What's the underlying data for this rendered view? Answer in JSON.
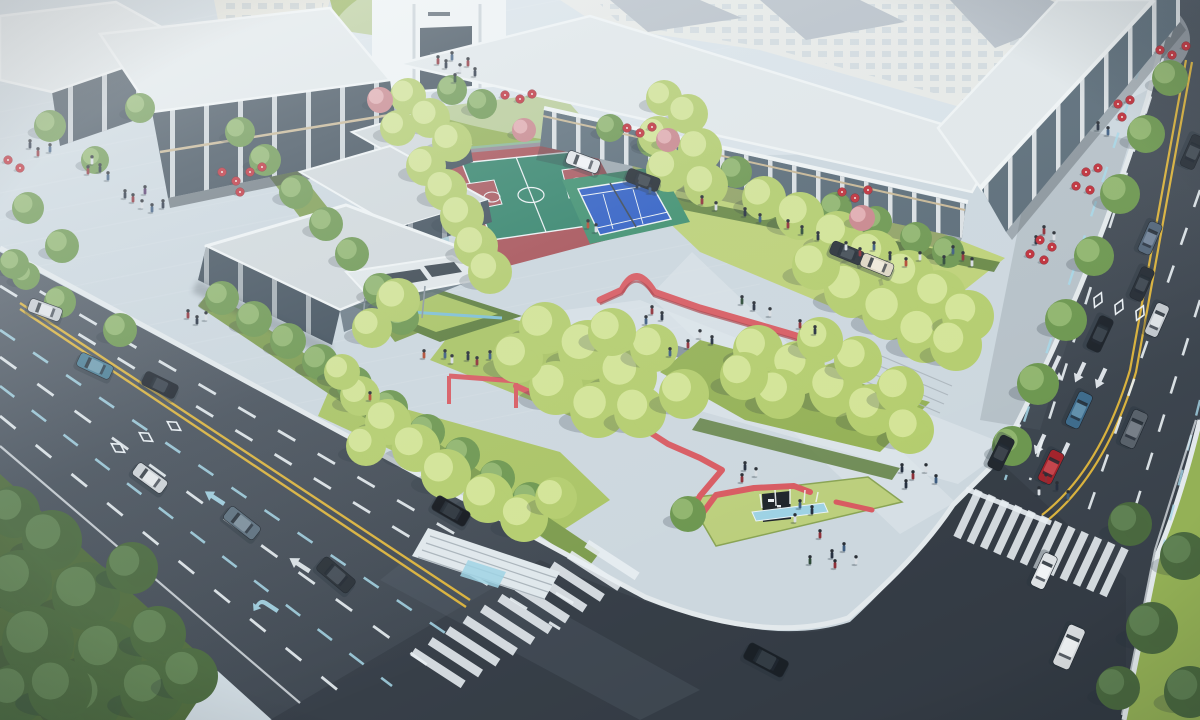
{
  "scene": {
    "description": "aerial-architectural-rendering-urban-pocket-park",
    "features": [
      "basketball-court",
      "tennis-court",
      "red-ribbon-walls",
      "park-entry-sign",
      "fountain",
      "pavilions",
      "commercial-buildings",
      "residential-blocks",
      "two-arterial-roads",
      "intersection",
      "crosswalks",
      "street-trees",
      "cafe-umbrellas",
      "pedestrians",
      "vehicles"
    ]
  },
  "palette": {
    "plaza": "#ccd7de",
    "plazaLight": "#e0e8ec",
    "path": "#d7e0e5",
    "bandLine": "#f2f6f8",
    "asphalt1": "#57616c",
    "asphalt2": "#3b434d",
    "asphaltDark": "#2f363e",
    "laneWhite": "#e9eff3",
    "laneCyan": "#a6d7e8",
    "laneYellow": "#d9b23e",
    "curb": "#e3e9ec",
    "lawn": "#aac465",
    "lawnLight": "#bdd177",
    "lawnShade": "#94b156",
    "verge": "#7d9c4e",
    "hedge": "#5f7f40",
    "hedgeLight": "#bccf7d",
    "bank": "#4f6b3d",
    "roof": "#d2d9dc",
    "roofLight": "#e2e8ea",
    "fascia": "#f0f4f5",
    "glassDark": "#414f5b",
    "glassMid": "#5a6b77",
    "colWhite": "#e9edef",
    "trim": "#c8b795",
    "resWall": "#e6e5da",
    "resWin": "#9db0bd",
    "resRoof": "#8c98a2",
    "courtRed": "#a85157",
    "courtGreen": "#33836a",
    "courtKey": "#a8565c",
    "tennisBlue": "#2f5ec4",
    "tennisGreen": "#3e8f6e",
    "lineWhite": "#eef3f5",
    "fence": "#7fb9c8",
    "ribbon": "#d85b62",
    "ribbonDark": "#aa4049",
    "water": "#9ed2e4",
    "waterDeep": "#7fc0d6",
    "umbrella": "#bf2f3a",
    "umbrellaDot": "#f0e8e2",
    "shadow": "#26323c",
    "carWindow": "#222a33",
    "signPanel": "#20262c",
    "signGlyph": "#e8ecef",
    "netDark": "#3a4754",
    "stepLine": "#aab4bb",
    "poleGray": "#8b97a0"
  },
  "tree_colors": {
    "p": {
      "b": "#b4cd6e",
      "h": "#d6e79a"
    },
    "s": {
      "b": "#6d9750",
      "h": "#93b871"
    },
    "d": {
      "b": "#4a693f",
      "h": "#628455"
    },
    "k": {
      "b": "#c9868c",
      "h": "#e4b0b4"
    }
  },
  "trees": [
    [
      14,
      512,
      26,
      "d"
    ],
    [
      52,
      540,
      30,
      "d"
    ],
    [
      20,
      582,
      32,
      "d"
    ],
    [
      86,
      596,
      34,
      "d"
    ],
    [
      38,
      642,
      36,
      "d"
    ],
    [
      108,
      655,
      34,
      "d"
    ],
    [
      16,
      694,
      30,
      "d"
    ],
    [
      88,
      700,
      34,
      "d"
    ],
    [
      152,
      692,
      32,
      "d"
    ],
    [
      158,
      634,
      28,
      "d"
    ],
    [
      132,
      568,
      26,
      "d"
    ],
    [
      190,
      676,
      28,
      "d"
    ],
    [
      60,
      690,
      32,
      "d"
    ],
    [
      222,
      298,
      17,
      "s"
    ],
    [
      254,
      319,
      18,
      "s"
    ],
    [
      288,
      341,
      18,
      "s"
    ],
    [
      320,
      362,
      18,
      "s"
    ],
    [
      354,
      384,
      18,
      "s"
    ],
    [
      390,
      408,
      18,
      "s"
    ],
    [
      427,
      432,
      18,
      "s"
    ],
    [
      462,
      455,
      18,
      "s"
    ],
    [
      497,
      478,
      18,
      "s"
    ],
    [
      530,
      500,
      18,
      "s"
    ],
    [
      60,
      302,
      16,
      "s"
    ],
    [
      120,
      330,
      17,
      "s"
    ],
    [
      26,
      276,
      14,
      "s"
    ],
    [
      140,
      108,
      15,
      "s"
    ],
    [
      240,
      132,
      15,
      "s"
    ],
    [
      265,
      160,
      16,
      "s"
    ],
    [
      296,
      192,
      17,
      "s"
    ],
    [
      326,
      224,
      17,
      "s"
    ],
    [
      352,
      254,
      17,
      "s"
    ],
    [
      380,
      290,
      17,
      "s"
    ],
    [
      402,
      318,
      17,
      "s"
    ],
    [
      50,
      126,
      16,
      "s"
    ],
    [
      28,
      208,
      16,
      "s"
    ],
    [
      62,
      246,
      17,
      "s"
    ],
    [
      14,
      264,
      15,
      "s"
    ],
    [
      95,
      160,
      14,
      "s"
    ],
    [
      452,
      90,
      15,
      "s"
    ],
    [
      482,
      104,
      15,
      "s"
    ],
    [
      610,
      128,
      14,
      "s"
    ],
    [
      652,
      142,
      15,
      "s"
    ],
    [
      694,
      158,
      16,
      "s"
    ],
    [
      736,
      172,
      16,
      "s"
    ],
    [
      836,
      208,
      16,
      "s"
    ],
    [
      876,
      222,
      16,
      "s"
    ],
    [
      916,
      238,
      16,
      "s"
    ],
    [
      948,
      252,
      16,
      "s"
    ],
    [
      408,
      96,
      18,
      "p"
    ],
    [
      430,
      118,
      20,
      "p"
    ],
    [
      452,
      142,
      20,
      "p"
    ],
    [
      426,
      166,
      20,
      "p"
    ],
    [
      398,
      128,
      18,
      "p"
    ],
    [
      446,
      190,
      21,
      "p"
    ],
    [
      462,
      216,
      22,
      "p"
    ],
    [
      476,
      246,
      22,
      "p"
    ],
    [
      490,
      272,
      22,
      "p"
    ],
    [
      664,
      98,
      18,
      "p"
    ],
    [
      688,
      114,
      20,
      "p"
    ],
    [
      658,
      136,
      20,
      "p"
    ],
    [
      700,
      150,
      22,
      "p"
    ],
    [
      668,
      170,
      22,
      "p"
    ],
    [
      706,
      185,
      22,
      "p"
    ],
    [
      764,
      198,
      22,
      "p"
    ],
    [
      800,
      216,
      24,
      "p"
    ],
    [
      838,
      236,
      25,
      "p"
    ],
    [
      874,
      256,
      26,
      "p"
    ],
    [
      908,
      276,
      26,
      "p"
    ],
    [
      940,
      296,
      26,
      "p"
    ],
    [
      852,
      290,
      28,
      "p"
    ],
    [
      890,
      312,
      28,
      "p"
    ],
    [
      925,
      335,
      28,
      "p"
    ],
    [
      816,
      266,
      24,
      "p"
    ],
    [
      968,
      316,
      26,
      "p"
    ],
    [
      956,
      345,
      26,
      "p"
    ],
    [
      545,
      328,
      26,
      "p"
    ],
    [
      588,
      350,
      30,
      "p"
    ],
    [
      628,
      376,
      29,
      "p"
    ],
    [
      556,
      388,
      27,
      "p"
    ],
    [
      598,
      410,
      28,
      "p"
    ],
    [
      518,
      358,
      25,
      "p"
    ],
    [
      654,
      348,
      24,
      "p"
    ],
    [
      640,
      412,
      26,
      "p"
    ],
    [
      684,
      394,
      25,
      "p"
    ],
    [
      612,
      332,
      24,
      "p"
    ],
    [
      758,
      350,
      25,
      "p"
    ],
    [
      798,
      368,
      27,
      "p"
    ],
    [
      836,
      390,
      27,
      "p"
    ],
    [
      872,
      410,
      26,
      "p"
    ],
    [
      900,
      390,
      24,
      "p"
    ],
    [
      858,
      360,
      24,
      "p"
    ],
    [
      820,
      340,
      23,
      "p"
    ],
    [
      780,
      394,
      25,
      "p"
    ],
    [
      744,
      376,
      24,
      "p"
    ],
    [
      910,
      430,
      24,
      "p"
    ],
    [
      360,
      396,
      20,
      "p"
    ],
    [
      388,
      422,
      23,
      "p"
    ],
    [
      416,
      448,
      24,
      "p"
    ],
    [
      366,
      446,
      20,
      "p"
    ],
    [
      446,
      474,
      25,
      "p"
    ],
    [
      488,
      498,
      25,
      "p"
    ],
    [
      342,
      372,
      18,
      "p"
    ],
    [
      524,
      518,
      24,
      "p"
    ],
    [
      556,
      498,
      21,
      "p"
    ],
    [
      688,
      514,
      18,
      "s"
    ],
    [
      398,
      300,
      22,
      "p"
    ],
    [
      372,
      328,
      20,
      "p"
    ],
    [
      1170,
      78,
      18,
      "s"
    ],
    [
      1146,
      134,
      19,
      "s"
    ],
    [
      1120,
      194,
      20,
      "s"
    ],
    [
      1094,
      256,
      20,
      "s"
    ],
    [
      1066,
      320,
      21,
      "s"
    ],
    [
      1038,
      384,
      21,
      "s"
    ],
    [
      1012,
      446,
      20,
      "s"
    ],
    [
      1130,
      524,
      22,
      "d"
    ],
    [
      1184,
      556,
      24,
      "d"
    ],
    [
      1152,
      628,
      26,
      "d"
    ],
    [
      1190,
      692,
      26,
      "d"
    ],
    [
      1118,
      688,
      22,
      "d"
    ],
    [
      380,
      100,
      13,
      "k"
    ],
    [
      524,
      130,
      12,
      "k"
    ],
    [
      668,
      140,
      12,
      "k"
    ],
    [
      862,
      218,
      13,
      "k"
    ]
  ],
  "cars": [
    {
      "x": 45,
      "y": 310,
      "r": 20,
      "l": 34,
      "w": 14,
      "b": "#c7ccd1",
      "t": "#e2e6e9"
    },
    {
      "x": 95,
      "y": 366,
      "r": 25,
      "l": 36,
      "w": 15,
      "b": "#4a7d94",
      "t": "#6f9cb0"
    },
    {
      "x": 160,
      "y": 385,
      "r": 26,
      "l": 36,
      "w": 15,
      "b": "#20262e",
      "t": "#3a434d"
    },
    {
      "x": 150,
      "y": 478,
      "r": 36,
      "l": 36,
      "w": 15,
      "b": "#ccd1d5",
      "t": "#e4e8ea"
    },
    {
      "x": 242,
      "y": 523,
      "r": 38,
      "l": 38,
      "w": 16,
      "b": "#5d707e",
      "t": "#7d8f9c"
    },
    {
      "x": 336,
      "y": 575,
      "r": 40,
      "l": 40,
      "w": 17,
      "b": "#2a3138",
      "t": "#454e57"
    },
    {
      "x": 451,
      "y": 511,
      "r": 30,
      "l": 38,
      "w": 16,
      "b": "#14181e",
      "t": "#2e363e"
    },
    {
      "x": 766,
      "y": 660,
      "r": 28,
      "l": 44,
      "w": 18,
      "b": "#1a2026",
      "t": "#333c44"
    },
    {
      "x": 1100,
      "y": 334,
      "r": 115,
      "l": 36,
      "w": 15,
      "b": "#1e242b",
      "t": "#39424b"
    },
    {
      "x": 1079,
      "y": 410,
      "r": 115,
      "l": 37,
      "w": 15,
      "b": "#3f6c8c",
      "t": "#6290ac"
    },
    {
      "x": 1134,
      "y": 429,
      "r": 114,
      "l": 38,
      "w": 16,
      "b": "#59626b",
      "t": "#777f88"
    },
    {
      "x": 1142,
      "y": 284,
      "r": 114,
      "l": 34,
      "w": 14,
      "b": "#272e36",
      "t": "#414a53"
    },
    {
      "x": 1150,
      "y": 238,
      "r": 114,
      "l": 33,
      "w": 14,
      "b": "#54677a",
      "t": "#74859a"
    },
    {
      "x": 1157,
      "y": 320,
      "r": 114,
      "l": 34,
      "w": 14,
      "b": "#c2c8cd",
      "t": "#dde2e5"
    },
    {
      "x": 1001,
      "y": 453,
      "r": 116,
      "l": 35,
      "w": 15,
      "b": "#23292f",
      "t": "#3d444c"
    },
    {
      "x": 1051,
      "y": 467,
      "r": 116,
      "l": 34,
      "w": 15,
      "b": "#a3242c",
      "t": "#c4454c"
    },
    {
      "x": 1044,
      "y": 571,
      "r": 115,
      "l": 36,
      "w": 15,
      "b": "#dde1e4",
      "t": "#f0f3f5"
    },
    {
      "x": 1069,
      "y": 647,
      "r": 114,
      "l": 44,
      "w": 18,
      "b": "#d6dadd",
      "t": "#eceff1"
    },
    {
      "x": 1193,
      "y": 152,
      "r": 114,
      "l": 34,
      "w": 15,
      "b": "#2a3139",
      "t": "#454e57"
    },
    {
      "x": 583,
      "y": 162,
      "r": 20,
      "l": 34,
      "w": 14,
      "b": "#e3e6e9",
      "t": "#f2f4f6"
    },
    {
      "x": 643,
      "y": 180,
      "r": 20,
      "l": 34,
      "w": 14,
      "b": "#242b32",
      "t": "#3e474f"
    },
    {
      "x": 847,
      "y": 253,
      "r": 22,
      "l": 34,
      "w": 14,
      "b": "#2b323a",
      "t": "#454e57"
    },
    {
      "x": 877,
      "y": 265,
      "r": 22,
      "l": 33,
      "w": 14,
      "b": "#ded7c4",
      "t": "#efe9da"
    }
  ],
  "people_colors": [
    "#263040",
    "#8e3038",
    "#3d5c80",
    "#d8dde2",
    "#54386a",
    "#2e4a38",
    "#b24a32",
    "#e0e4e8"
  ],
  "people": [
    [
      30,
      146,
      0
    ],
    [
      38,
      154,
      1
    ],
    [
      50,
      150,
      2
    ],
    [
      92,
      162,
      3
    ],
    [
      100,
      170,
      0
    ],
    [
      88,
      172,
      1
    ],
    [
      108,
      178,
      2
    ],
    [
      125,
      196,
      0
    ],
    [
      133,
      200,
      1
    ],
    [
      142,
      206,
      3
    ],
    [
      152,
      210,
      2
    ],
    [
      163,
      206,
      0
    ],
    [
      145,
      192,
      4
    ],
    [
      438,
      62,
      1
    ],
    [
      446,
      66,
      0
    ],
    [
      452,
      58,
      2
    ],
    [
      460,
      70,
      3
    ],
    [
      468,
      64,
      1
    ],
    [
      475,
      74,
      0
    ],
    [
      455,
      80,
      5
    ],
    [
      637,
      186,
      0
    ],
    [
      650,
      191,
      2
    ],
    [
      702,
      202,
      1
    ],
    [
      716,
      208,
      3
    ],
    [
      745,
      214,
      0
    ],
    [
      760,
      220,
      2
    ],
    [
      788,
      226,
      1
    ],
    [
      802,
      232,
      5
    ],
    [
      818,
      238,
      0
    ],
    [
      846,
      248,
      3
    ],
    [
      860,
      254,
      1
    ],
    [
      874,
      248,
      2
    ],
    [
      890,
      258,
      0
    ],
    [
      906,
      264,
      6
    ],
    [
      920,
      258,
      3
    ],
    [
      1098,
      128,
      0
    ],
    [
      1108,
      133,
      2
    ],
    [
      1044,
      232,
      1
    ],
    [
      1054,
      238,
      3
    ],
    [
      1036,
      242,
      0
    ],
    [
      953,
      252,
      2
    ],
    [
      963,
      258,
      1
    ],
    [
      944,
      262,
      5
    ],
    [
      972,
      264,
      3
    ],
    [
      588,
      226,
      6
    ],
    [
      596,
      230,
      3
    ],
    [
      652,
      312,
      1
    ],
    [
      662,
      318,
      0
    ],
    [
      646,
      322,
      2
    ],
    [
      700,
      336,
      3
    ],
    [
      712,
      342,
      0
    ],
    [
      688,
      346,
      1
    ],
    [
      670,
      354,
      2
    ],
    [
      742,
      302,
      5
    ],
    [
      754,
      308,
      0
    ],
    [
      770,
      314,
      3
    ],
    [
      800,
      326,
      1
    ],
    [
      815,
      332,
      0
    ],
    [
      445,
      356,
      2
    ],
    [
      452,
      361,
      3
    ],
    [
      468,
      358,
      0
    ],
    [
      477,
      363,
      1
    ],
    [
      490,
      357,
      2
    ],
    [
      370,
      398,
      6
    ],
    [
      745,
      468,
      0
    ],
    [
      756,
      474,
      3
    ],
    [
      742,
      480,
      1
    ],
    [
      800,
      506,
      2
    ],
    [
      812,
      512,
      0
    ],
    [
      795,
      520,
      3
    ],
    [
      820,
      536,
      1
    ],
    [
      832,
      556,
      0
    ],
    [
      844,
      549,
      2
    ],
    [
      856,
      562,
      3
    ],
    [
      835,
      566,
      1
    ],
    [
      810,
      562,
      5
    ],
    [
      902,
      470,
      0
    ],
    [
      913,
      477,
      1
    ],
    [
      926,
      470,
      3
    ],
    [
      936,
      481,
      2
    ],
    [
      906,
      486,
      0
    ],
    [
      1046,
      480,
      1
    ],
    [
      1057,
      488,
      0
    ],
    [
      1039,
      493,
      3
    ],
    [
      1068,
      497,
      2
    ],
    [
      188,
      316,
      1
    ],
    [
      197,
      322,
      0
    ],
    [
      206,
      318,
      3
    ],
    [
      424,
      356,
      6
    ]
  ],
  "umbrellas": [
    [
      222,
      172
    ],
    [
      236,
      181
    ],
    [
      250,
      172
    ],
    [
      262,
      167
    ],
    [
      240,
      192
    ],
    [
      8,
      160
    ],
    [
      20,
      168
    ],
    [
      505,
      95
    ],
    [
      520,
      99
    ],
    [
      532,
      94
    ],
    [
      627,
      128
    ],
    [
      640,
      133
    ],
    [
      652,
      127
    ],
    [
      842,
      192
    ],
    [
      855,
      198
    ],
    [
      868,
      190
    ],
    [
      1160,
      50
    ],
    [
      1172,
      55
    ],
    [
      1186,
      46
    ],
    [
      1118,
      104
    ],
    [
      1130,
      100
    ],
    [
      1122,
      117
    ],
    [
      1086,
      172
    ],
    [
      1098,
      168
    ],
    [
      1076,
      186
    ],
    [
      1090,
      190
    ],
    [
      1040,
      240
    ],
    [
      1052,
      247
    ],
    [
      1030,
      254
    ],
    [
      1044,
      260
    ]
  ],
  "crosswalks": [
    {
      "x1": 438,
      "y1": 668,
      "x2": 612,
      "y2": 560,
      "n": 11,
      "half": 30,
      "ang": 33,
      "w": 9
    },
    {
      "x1": 968,
      "y1": 514,
      "x2": 1114,
      "y2": 572,
      "n": 12,
      "half": 26,
      "ang": 115,
      "w": 8
    }
  ],
  "paving_bands": {
    "n": 18,
    "y0": 58,
    "dy": 27,
    "slope": -0.2,
    "len": 760
  }
}
